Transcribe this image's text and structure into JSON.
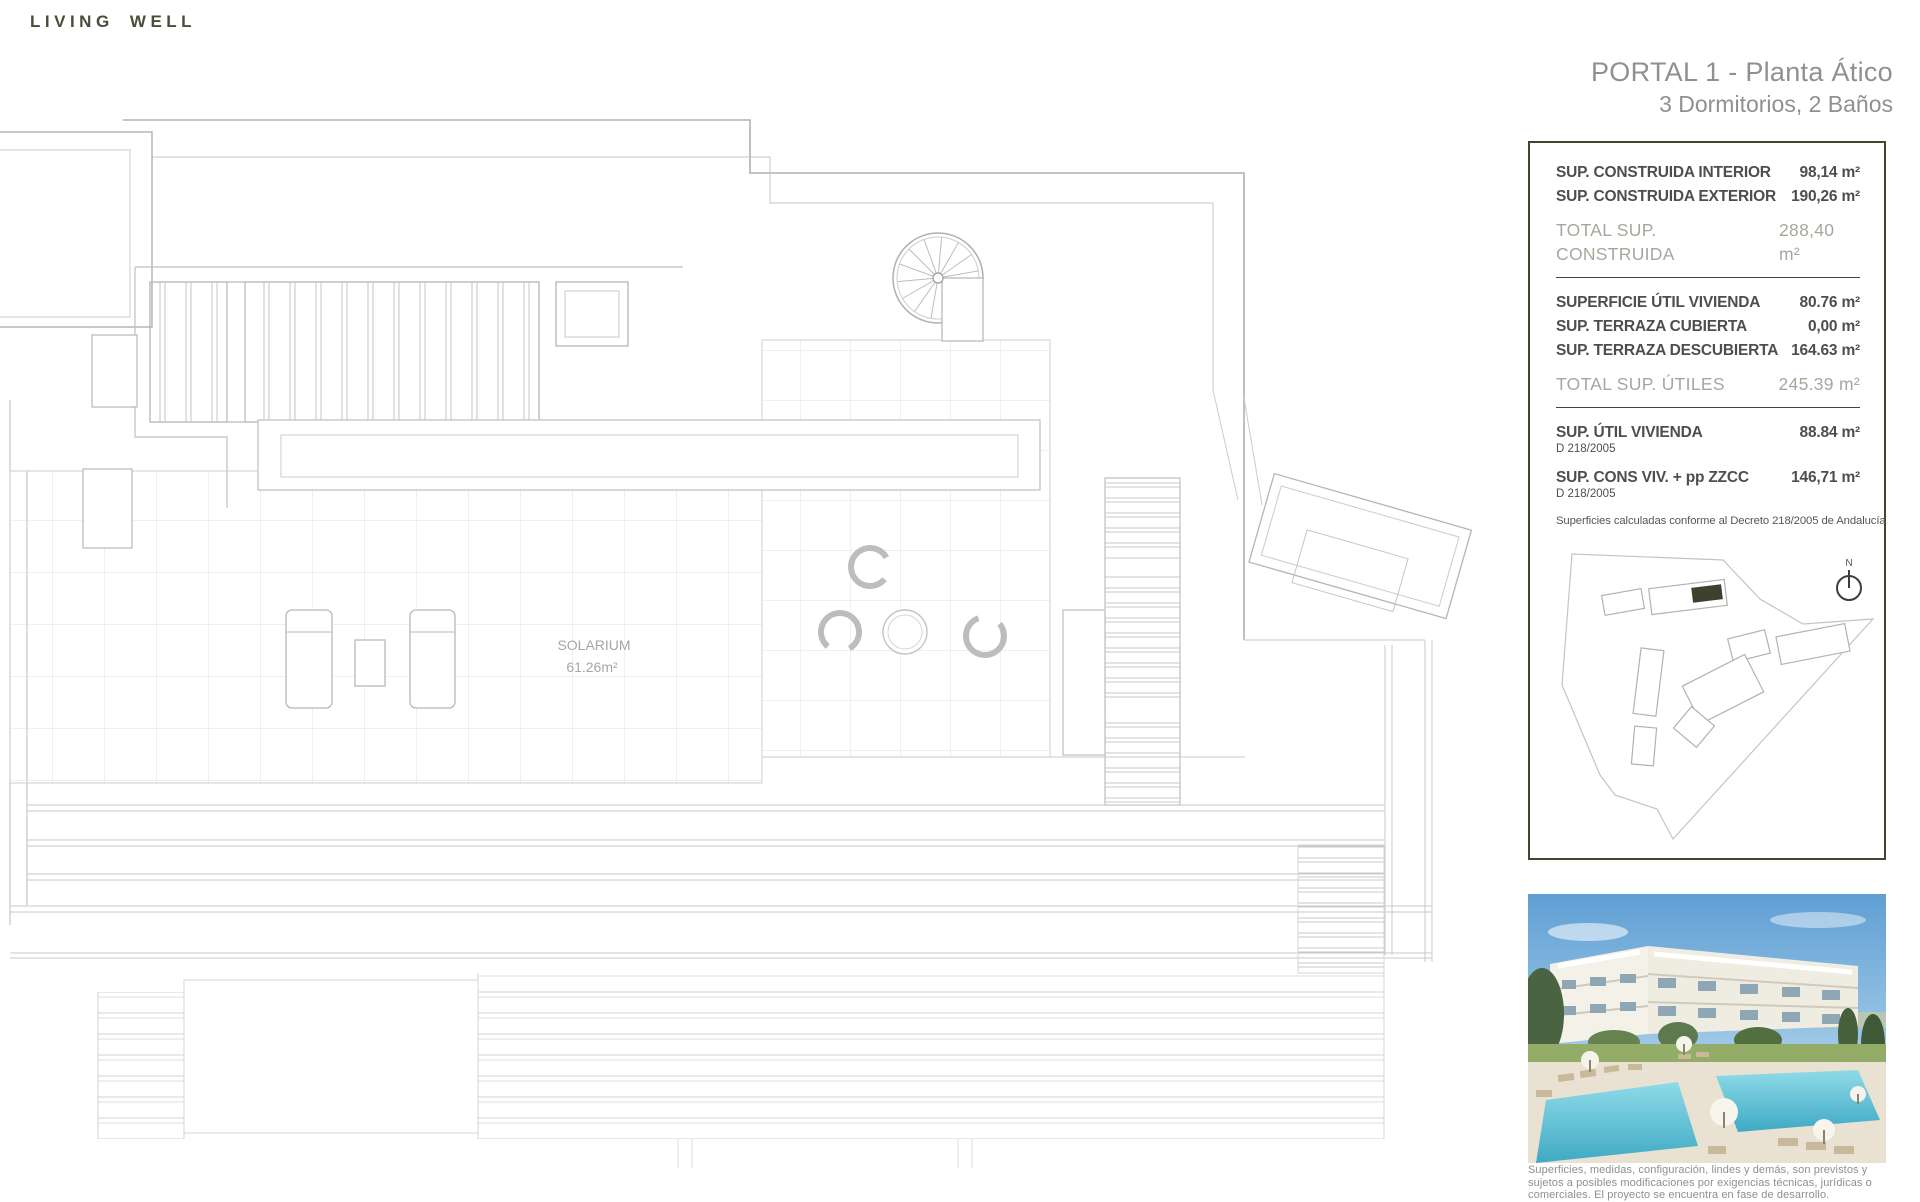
{
  "brand": {
    "logo": "LIVING WELL"
  },
  "header": {
    "title_line1": "PORTAL 1 - Planta Ático",
    "title_line2": "3 Dormitorios, 2 Baños"
  },
  "info_panel": {
    "construida": {
      "rows": [
        {
          "label": "SUP. CONSTRUIDA INTERIOR",
          "value": "98,14 m²"
        },
        {
          "label": "SUP. CONSTRUIDA EXTERIOR",
          "value": "190,26 m²"
        }
      ],
      "total": {
        "label": "TOTAL SUP. CONSTRUIDA",
        "value": "288,40 m²"
      }
    },
    "utiles": {
      "rows": [
        {
          "label": "SUPERFICIE ÚTIL VIVIENDA",
          "value": "80.76 m²"
        },
        {
          "label": "SUP. TERRAZA CUBIERTA",
          "value": "0,00 m²"
        },
        {
          "label": "SUP. TERRAZA DESCUBIERTA",
          "value": "164.63 m²"
        }
      ],
      "total": {
        "label": "TOTAL SUP. ÚTILES",
        "value": "245.39 m²"
      }
    },
    "decreto": {
      "rows": [
        {
          "label": "SUP. ÚTIL VIVIENDA",
          "value": "88.84 m²",
          "note": "D 218/2005"
        },
        {
          "label": "SUP. CONS VIV. + pp ZZCC",
          "value": "146,71 m²",
          "note": "D 218/2005"
        }
      ],
      "footnote": "Superficies calculadas conforme al Decreto 218/2005 de Andalucía"
    }
  },
  "site_map": {
    "north_label": "N",
    "highlight_color": "#3f402e"
  },
  "floor_plan": {
    "room_label": "SOLARIUM",
    "room_area": "61.26m²"
  },
  "disclaimer": {
    "line1": "Superficies, medidas, configuración, lindes y demás, son previstos y",
    "line2": "sujetos a posibles modificaciones por exigencias técnicas, jurídicas o",
    "line3": "comerciales. El proyecto se encuentra en fase de desarrollo."
  },
  "colors": {
    "accent": "#43462f",
    "plan_line": "#c6c6c6",
    "title_gray": "#8f9090"
  }
}
